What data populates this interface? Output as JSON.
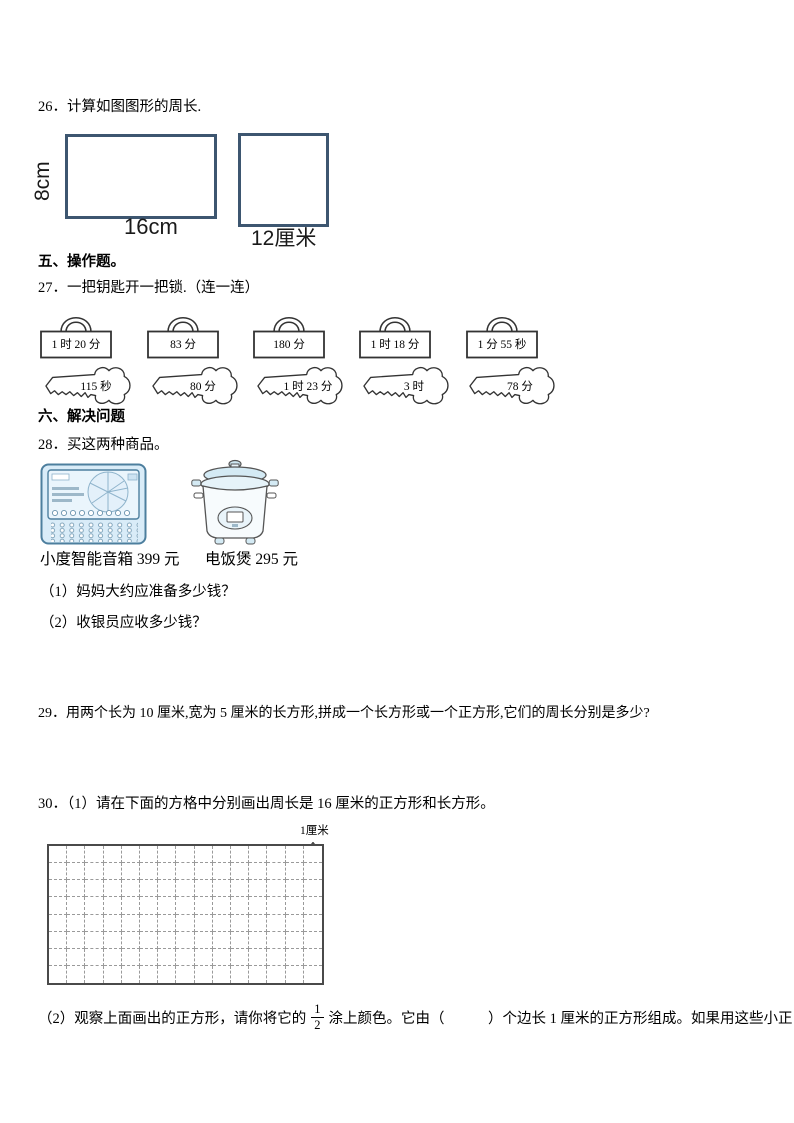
{
  "colors": {
    "shape_border": "#3d5670",
    "appliance_fill": "#d9ecf8",
    "appliance_line": "#4d7f9e",
    "outline": "#333333"
  },
  "q26": {
    "title": "26．计算如图图形的周长.",
    "rect_height_label": "8cm",
    "rect_width_label": "16cm",
    "square_side_label": "12厘米"
  },
  "section5": "五、操作题。",
  "q27": {
    "title": "27．一把钥匙开一把锁.（连一连）",
    "locks": [
      "1 时 20 分",
      "83 分",
      "180 分",
      "1 时 18 分",
      "1 分 55 秒"
    ],
    "keys": [
      "115 秒",
      "80 分",
      "1 时 23 分",
      "3 时",
      "78 分"
    ]
  },
  "section6": "六、解决问题",
  "q28": {
    "title": "28．买这两种商品。",
    "product1_label": "小度智能音箱 399 元",
    "product2_label": "电饭煲 295 元",
    "sub1": "（1）妈妈大约应准备多少钱？",
    "sub2": "（2）收银员应收多少钱？"
  },
  "q29": {
    "title": "29．用两个长为 10 厘米,宽为 5 厘米的长方形,拼成一个长方形或一个正方形,它们的周长分别是多少?"
  },
  "q30": {
    "part1": "30．（1）请在下面的方格中分别画出周长是 16 厘米的正方形和长方形。",
    "grid_unit_label": "1厘米",
    "grid": {
      "rows": 8,
      "cols": 15
    },
    "part2_before_fraction": "（2）观察上面画出的正方形，请你将它的",
    "fraction": {
      "numerator": "1",
      "denominator": "2"
    },
    "part2_after_fraction": "涂上颜色。它由（　　　）个边长 1 厘米的正方形组成。如果用这些小正"
  }
}
